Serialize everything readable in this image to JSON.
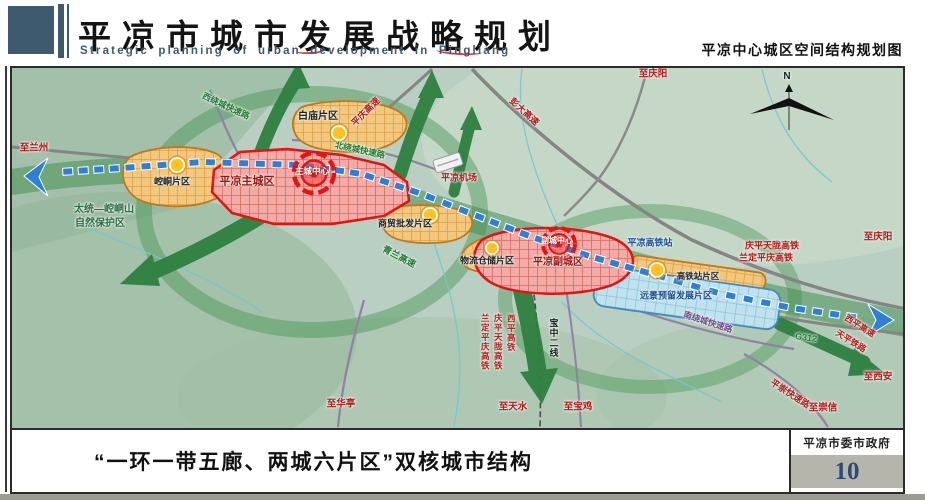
{
  "header": {
    "title": "平凉市城市发展战略规划",
    "subtitle_en": "Strategic planning of urban development in Pingliang",
    "sheet_title": "平凉中心城区空间结构规划图"
  },
  "footer": {
    "caption": "“一环一带五廊、两城六片区”双核城市结构",
    "agency": "平凉市委市政府",
    "page_number": "10"
  },
  "colors": {
    "red": "#b51a1a",
    "green": "#1f7a33",
    "dgreen": "#2c6e46",
    "blue": "#1b5096",
    "purple": "#6e4e8e",
    "dred": "#9e1212",
    "black": "#222222",
    "white": "#ffffff",
    "chain_blue": "#2f7fd6"
  },
  "map": {
    "compass_label": "N",
    "labels": [
      {
        "text": "至兰州",
        "x": 34,
        "y": 148,
        "c": "red",
        "fs": 9.5
      },
      {
        "text": "太统—崆峒山",
        "x": 104,
        "y": 210,
        "c": "dgreen",
        "fs": 10
      },
      {
        "text": "自然保护区",
        "x": 100,
        "y": 224,
        "c": "dgreen",
        "fs": 10
      },
      {
        "text": "崆峒片区",
        "x": 172,
        "y": 182,
        "c": "black",
        "fs": 9
      },
      {
        "text": "白庙片区",
        "x": 318,
        "y": 117,
        "c": "black",
        "fs": 10
      },
      {
        "text": "平凉主城区",
        "x": 247,
        "y": 182,
        "c": "dred",
        "fs": 11,
        "bold": true
      },
      {
        "text": "主城中心",
        "x": 312,
        "y": 171,
        "c": "white",
        "fs": 8.5,
        "bold": true
      },
      {
        "text": "西绕城快速路",
        "x": 226,
        "y": 106,
        "c": "green",
        "fs": 8.5,
        "rot": 25
      },
      {
        "text": "北绕城快速路",
        "x": 360,
        "y": 150,
        "c": "green",
        "fs": 8.5,
        "rot": 12
      },
      {
        "text": "平庆高速",
        "x": 366,
        "y": 112,
        "c": "red",
        "fs": 9,
        "rot": -45
      },
      {
        "text": "彭大高速",
        "x": 524,
        "y": 112,
        "c": "red",
        "fs": 9,
        "rot": 42
      },
      {
        "text": "平凉机场",
        "x": 459,
        "y": 178,
        "c": "red",
        "fs": 9
      },
      {
        "text": "至庆阳",
        "x": 653,
        "y": 74,
        "c": "red",
        "fs": 9.5
      },
      {
        "text": "商贸批发片区",
        "x": 405,
        "y": 224,
        "c": "black",
        "fs": 9
      },
      {
        "text": "物流仓储片区",
        "x": 487,
        "y": 261,
        "c": "black",
        "fs": 9
      },
      {
        "text": "青兰高速",
        "x": 399,
        "y": 257,
        "c": "green",
        "fs": 9,
        "rot": 28
      },
      {
        "text": "平凉副城区",
        "x": 558,
        "y": 263,
        "c": "dred",
        "fs": 10,
        "bold": true
      },
      {
        "text": "副城中心",
        "x": 557,
        "y": 241,
        "c": "white",
        "fs": 8,
        "bold": true
      },
      {
        "text": "平凉高铁站",
        "x": 650,
        "y": 243,
        "c": "blue",
        "fs": 9
      },
      {
        "text": "庆平天陇高铁",
        "x": 772,
        "y": 246,
        "c": "red",
        "fs": 9
      },
      {
        "text": "兰定平庆高铁",
        "x": 766,
        "y": 258,
        "c": "red",
        "fs": 9
      },
      {
        "text": "至庆阳",
        "x": 878,
        "y": 237,
        "c": "red",
        "fs": 9.5
      },
      {
        "text": "高铁站片区",
        "x": 698,
        "y": 276,
        "c": "black",
        "fs": 8.5
      },
      {
        "text": "远景预留发展片区",
        "x": 676,
        "y": 296,
        "c": "blue",
        "fs": 9
      },
      {
        "text": "南绕城快速路",
        "x": 708,
        "y": 322,
        "c": "purple",
        "fs": 8.5,
        "rot": 18
      },
      {
        "text": "G312",
        "x": 806,
        "y": 338,
        "c": "green",
        "fs": 9,
        "rot": 8
      },
      {
        "text": "西平高速",
        "x": 860,
        "y": 326,
        "c": "red",
        "fs": 8.5,
        "rot": 32
      },
      {
        "text": "天平铁路",
        "x": 851,
        "y": 341,
        "c": "red",
        "fs": 8.5,
        "rot": 32
      },
      {
        "text": "至西安",
        "x": 878,
        "y": 377,
        "c": "red",
        "fs": 9.5
      },
      {
        "text": "平崇快速路",
        "x": 790,
        "y": 394,
        "c": "red",
        "fs": 9,
        "rot": 33
      },
      {
        "text": "至崇信",
        "x": 823,
        "y": 408,
        "c": "red",
        "fs": 9.5
      },
      {
        "text": "至华亭",
        "x": 341,
        "y": 404,
        "c": "red",
        "fs": 9.5
      },
      {
        "text": "至天水",
        "x": 513,
        "y": 407,
        "c": "red",
        "fs": 9.5
      },
      {
        "text": "至宝鸡",
        "x": 578,
        "y": 407,
        "c": "red",
        "fs": 9.5
      },
      {
        "text": "宝中二线",
        "x": 553,
        "y": 338,
        "c": "black",
        "fs": 9,
        "vert": true
      },
      {
        "text": "兰定平庆高铁",
        "x": 485,
        "y": 342,
        "c": "red",
        "fs": 8.5,
        "vert": true
      },
      {
        "text": "庆平天陇高铁",
        "x": 498,
        "y": 342,
        "c": "red",
        "fs": 8.5,
        "vert": true
      },
      {
        "text": "西平高铁",
        "x": 511,
        "y": 333,
        "c": "red",
        "fs": 8.5,
        "vert": true
      },
      {
        "text": "N",
        "x": 787,
        "y": 77,
        "c": "black",
        "fs": 10,
        "bold": true
      }
    ]
  }
}
